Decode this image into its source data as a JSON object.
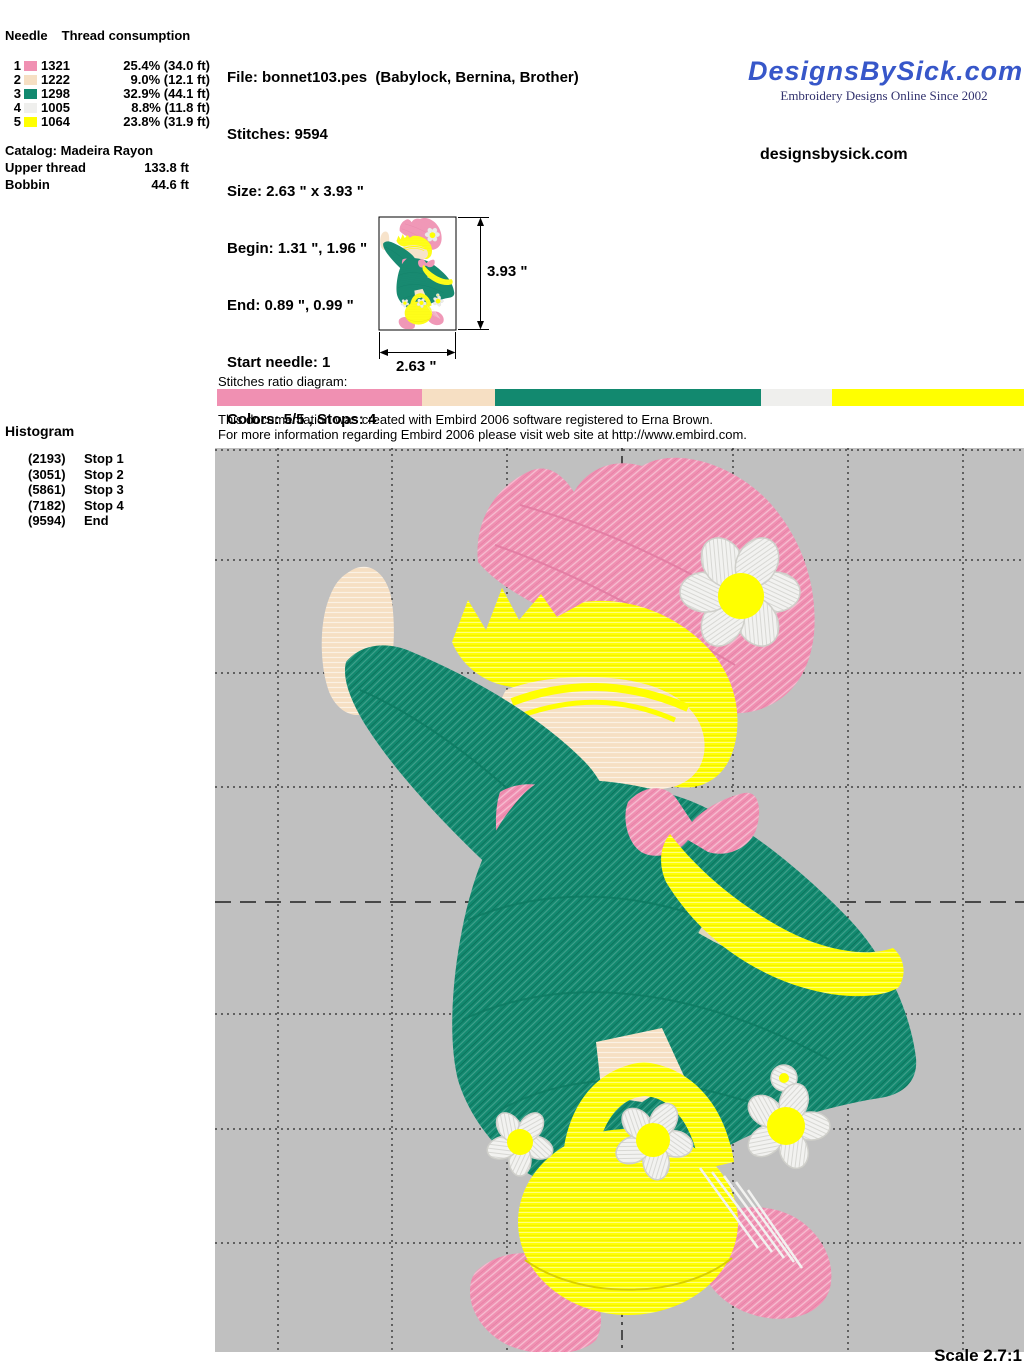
{
  "thread_table": {
    "col_needle": "Needle",
    "col_consumption": "Thread consumption",
    "rows": [
      {
        "needle": "1",
        "color": "#F090B2",
        "code": "1321",
        "consumption": "25.4% (34.0 ft)"
      },
      {
        "needle": "2",
        "color": "#F6DFC3",
        "code": "1222",
        "consumption": "9.0% (12.1 ft)"
      },
      {
        "needle": "3",
        "color": "#12896F",
        "code": "1298",
        "consumption": "32.9% (44.1 ft)"
      },
      {
        "needle": "4",
        "color": "#EFEFED",
        "code": "1005",
        "consumption": "8.8% (11.8 ft)"
      },
      {
        "needle": "5",
        "color": "#FFFF00",
        "code": "1064",
        "consumption": "23.8% (31.9 ft)"
      }
    ],
    "catalog": "Catalog: Madeira Rayon",
    "upper_thread_label": "Upper thread",
    "upper_thread_value": "133.8 ft",
    "bobbin_label": "Bobbin",
    "bobbin_value": "44.6 ft"
  },
  "file_info": {
    "file": "File: bonnet103.pes  (Babylock, Bernina, Brother)",
    "stitches": "Stitches: 9594",
    "size": "Size: 2.63 \" x 3.93 \"",
    "begin": "Begin: 1.31 \", 1.96 \"",
    "end": "End: 0.89 \", 0.99 \"",
    "start_needle": "Start needle: 1",
    "colors": "Colors: 5/5 , Stops: 4",
    "date": "Date: 1/1/2008"
  },
  "branding": {
    "logo": "DesignsBySick.com",
    "tagline": "Embroidery Designs Online Since 2002",
    "site": "designsbysick.com",
    "logo_color": "#3757C9"
  },
  "preview": {
    "height_label": "3.93 \"",
    "width_label": "2.63 \""
  },
  "ratio": {
    "label": "Stitches ratio diagram:",
    "segments": [
      {
        "name": "pink",
        "color": "#F090B2",
        "pct": 25.4
      },
      {
        "name": "cream",
        "color": "#F6DFC3",
        "pct": 9.0
      },
      {
        "name": "teal",
        "color": "#12896F",
        "pct": 32.9
      },
      {
        "name": "white",
        "color": "#EFEFED",
        "pct": 8.8
      },
      {
        "name": "yellow",
        "color": "#FFFF00",
        "pct": 23.8
      }
    ]
  },
  "embird_note": {
    "line1": "This documentation was created with Embird 2006 software registered to Erna Brown.",
    "line2": "For more information regarding Embird 2006 please visit web site at http://www.embird.com."
  },
  "histogram": {
    "title": "Histogram",
    "entries": [
      {
        "count": "(2193)",
        "label": "Stop 1"
      },
      {
        "count": "(3051)",
        "label": "Stop 2"
      },
      {
        "count": "(5861)",
        "label": "Stop 3"
      },
      {
        "count": "(7182)",
        "label": "Stop 4"
      },
      {
        "count": "(9594)",
        "label": "End"
      }
    ]
  },
  "design": {
    "canvas_color": "#C0C0C0",
    "thread_colors": {
      "pink": "#F090B2",
      "cream": "#F6DFC3",
      "teal": "#12896F",
      "white": "#F0F0EE",
      "yellow": "#FFFF00"
    }
  },
  "scale_label": "Scale 2.7:1"
}
